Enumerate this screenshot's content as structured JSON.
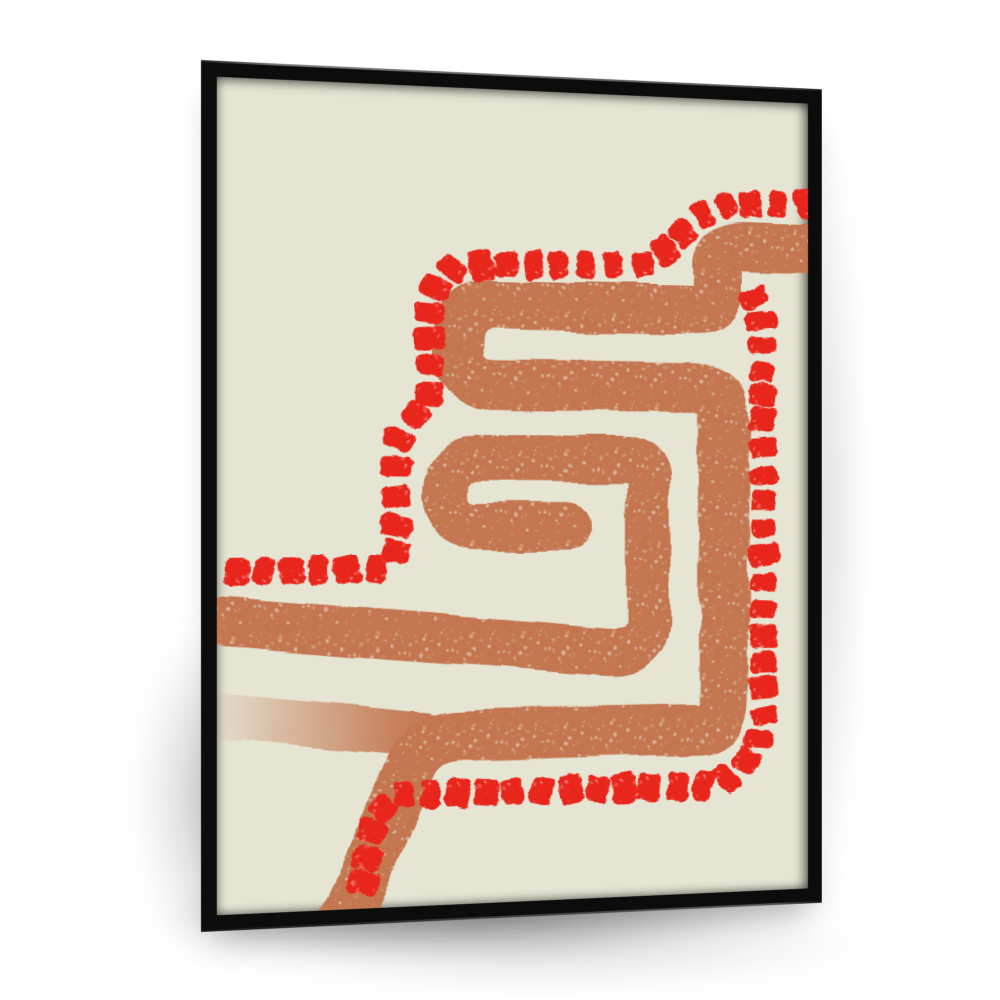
{
  "scene": {
    "wall_color": "#ffffff",
    "shadow_color": "rgba(0,0,0,0.35)"
  },
  "frame": {
    "color": "#0c0c0c",
    "left": 201,
    "top": 60,
    "width": 672,
    "height": 872,
    "border": 16,
    "perspective": 1300,
    "rotate_y_deg": 8
  },
  "canvas": {
    "background": "#e6e4d3",
    "viewbox": [
      0,
      0,
      580,
      814
    ]
  },
  "artwork": {
    "path_color": "#c3764f",
    "path_speckle": [
      "#d8a77e",
      "#e6e4d3"
    ],
    "dot_color": "#e8261b",
    "dot_speckle": [
      "#f4857a",
      "#fbd9d2"
    ],
    "strokes": [
      {
        "d": "M 4,621 L 198,645",
        "width": 44,
        "taper": true
      },
      {
        "d": "M -12,527 L 370,564 Q 414,570 416,534 L 416,392 Q 416,369 393,369 L 246,369 Q 214,369 214,403 Q 214,438 247,438 L 336,438",
        "width": 46,
        "taper": false
      },
      {
        "d": "M 604,151 L 513,151 Q 487,151 487,173 L 487,194 Q 487,216 463,216 L 265,216 Q 228,216 228,256 Q 228,296 265,296 L 461,296 Q 493,296 493,321 L 493,619 Q 493,646 466,646 L 234,646 Q 197,646 184,671 C 172,696 158,733 144,768 C 133,795 122,815 110,842",
        "width": 50,
        "taper": false
      }
    ],
    "dot_chains": [
      {
        "points": [
          [
            6,
            481
          ],
          [
            158,
            479
          ],
          [
            168,
            466
          ],
          [
            168,
            354
          ],
          [
            184,
            330
          ],
          [
            200,
            312
          ],
          [
            200,
            220
          ],
          [
            207,
            193
          ],
          [
            226,
            177
          ],
          [
            418,
            171
          ],
          [
            438,
            152
          ],
          [
            458,
            130
          ],
          [
            476,
            114
          ],
          [
            500,
            107
          ],
          [
            586,
            104
          ]
        ],
        "spacing": 27.5
      },
      {
        "points": [
          [
            518,
            192
          ],
          [
            531,
            222
          ],
          [
            534,
            420
          ],
          [
            534,
            638
          ],
          [
            527,
            664
          ],
          [
            512,
            686
          ],
          [
            492,
            698
          ],
          [
            472,
            704
          ],
          [
            170,
            703
          ],
          [
            149,
            722
          ],
          [
            143,
            748
          ],
          [
            139,
            772
          ],
          [
            133,
            814
          ]
        ],
        "spacing": 27
      }
    ],
    "dot_size": {
      "along": 21,
      "across": 28
    }
  }
}
